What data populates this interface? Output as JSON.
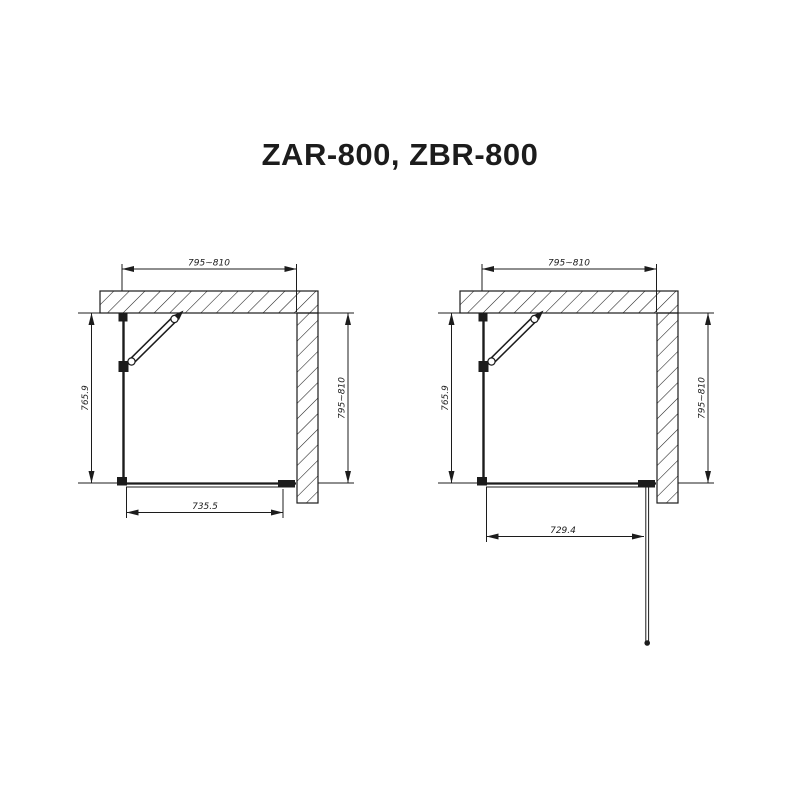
{
  "title": "ZAR-800, ZBR-800",
  "colors": {
    "line": "#1c1c1c",
    "background": "#ffffff"
  },
  "diagrams": [
    {
      "position": "left",
      "dims": {
        "top": "795~810",
        "left": "765.9",
        "right": "795~810",
        "bottom": "735.5"
      }
    },
    {
      "position": "right",
      "dims": {
        "top": "795~810",
        "left": "765.9",
        "right": "795~810",
        "bottom": "729.4"
      }
    }
  ]
}
